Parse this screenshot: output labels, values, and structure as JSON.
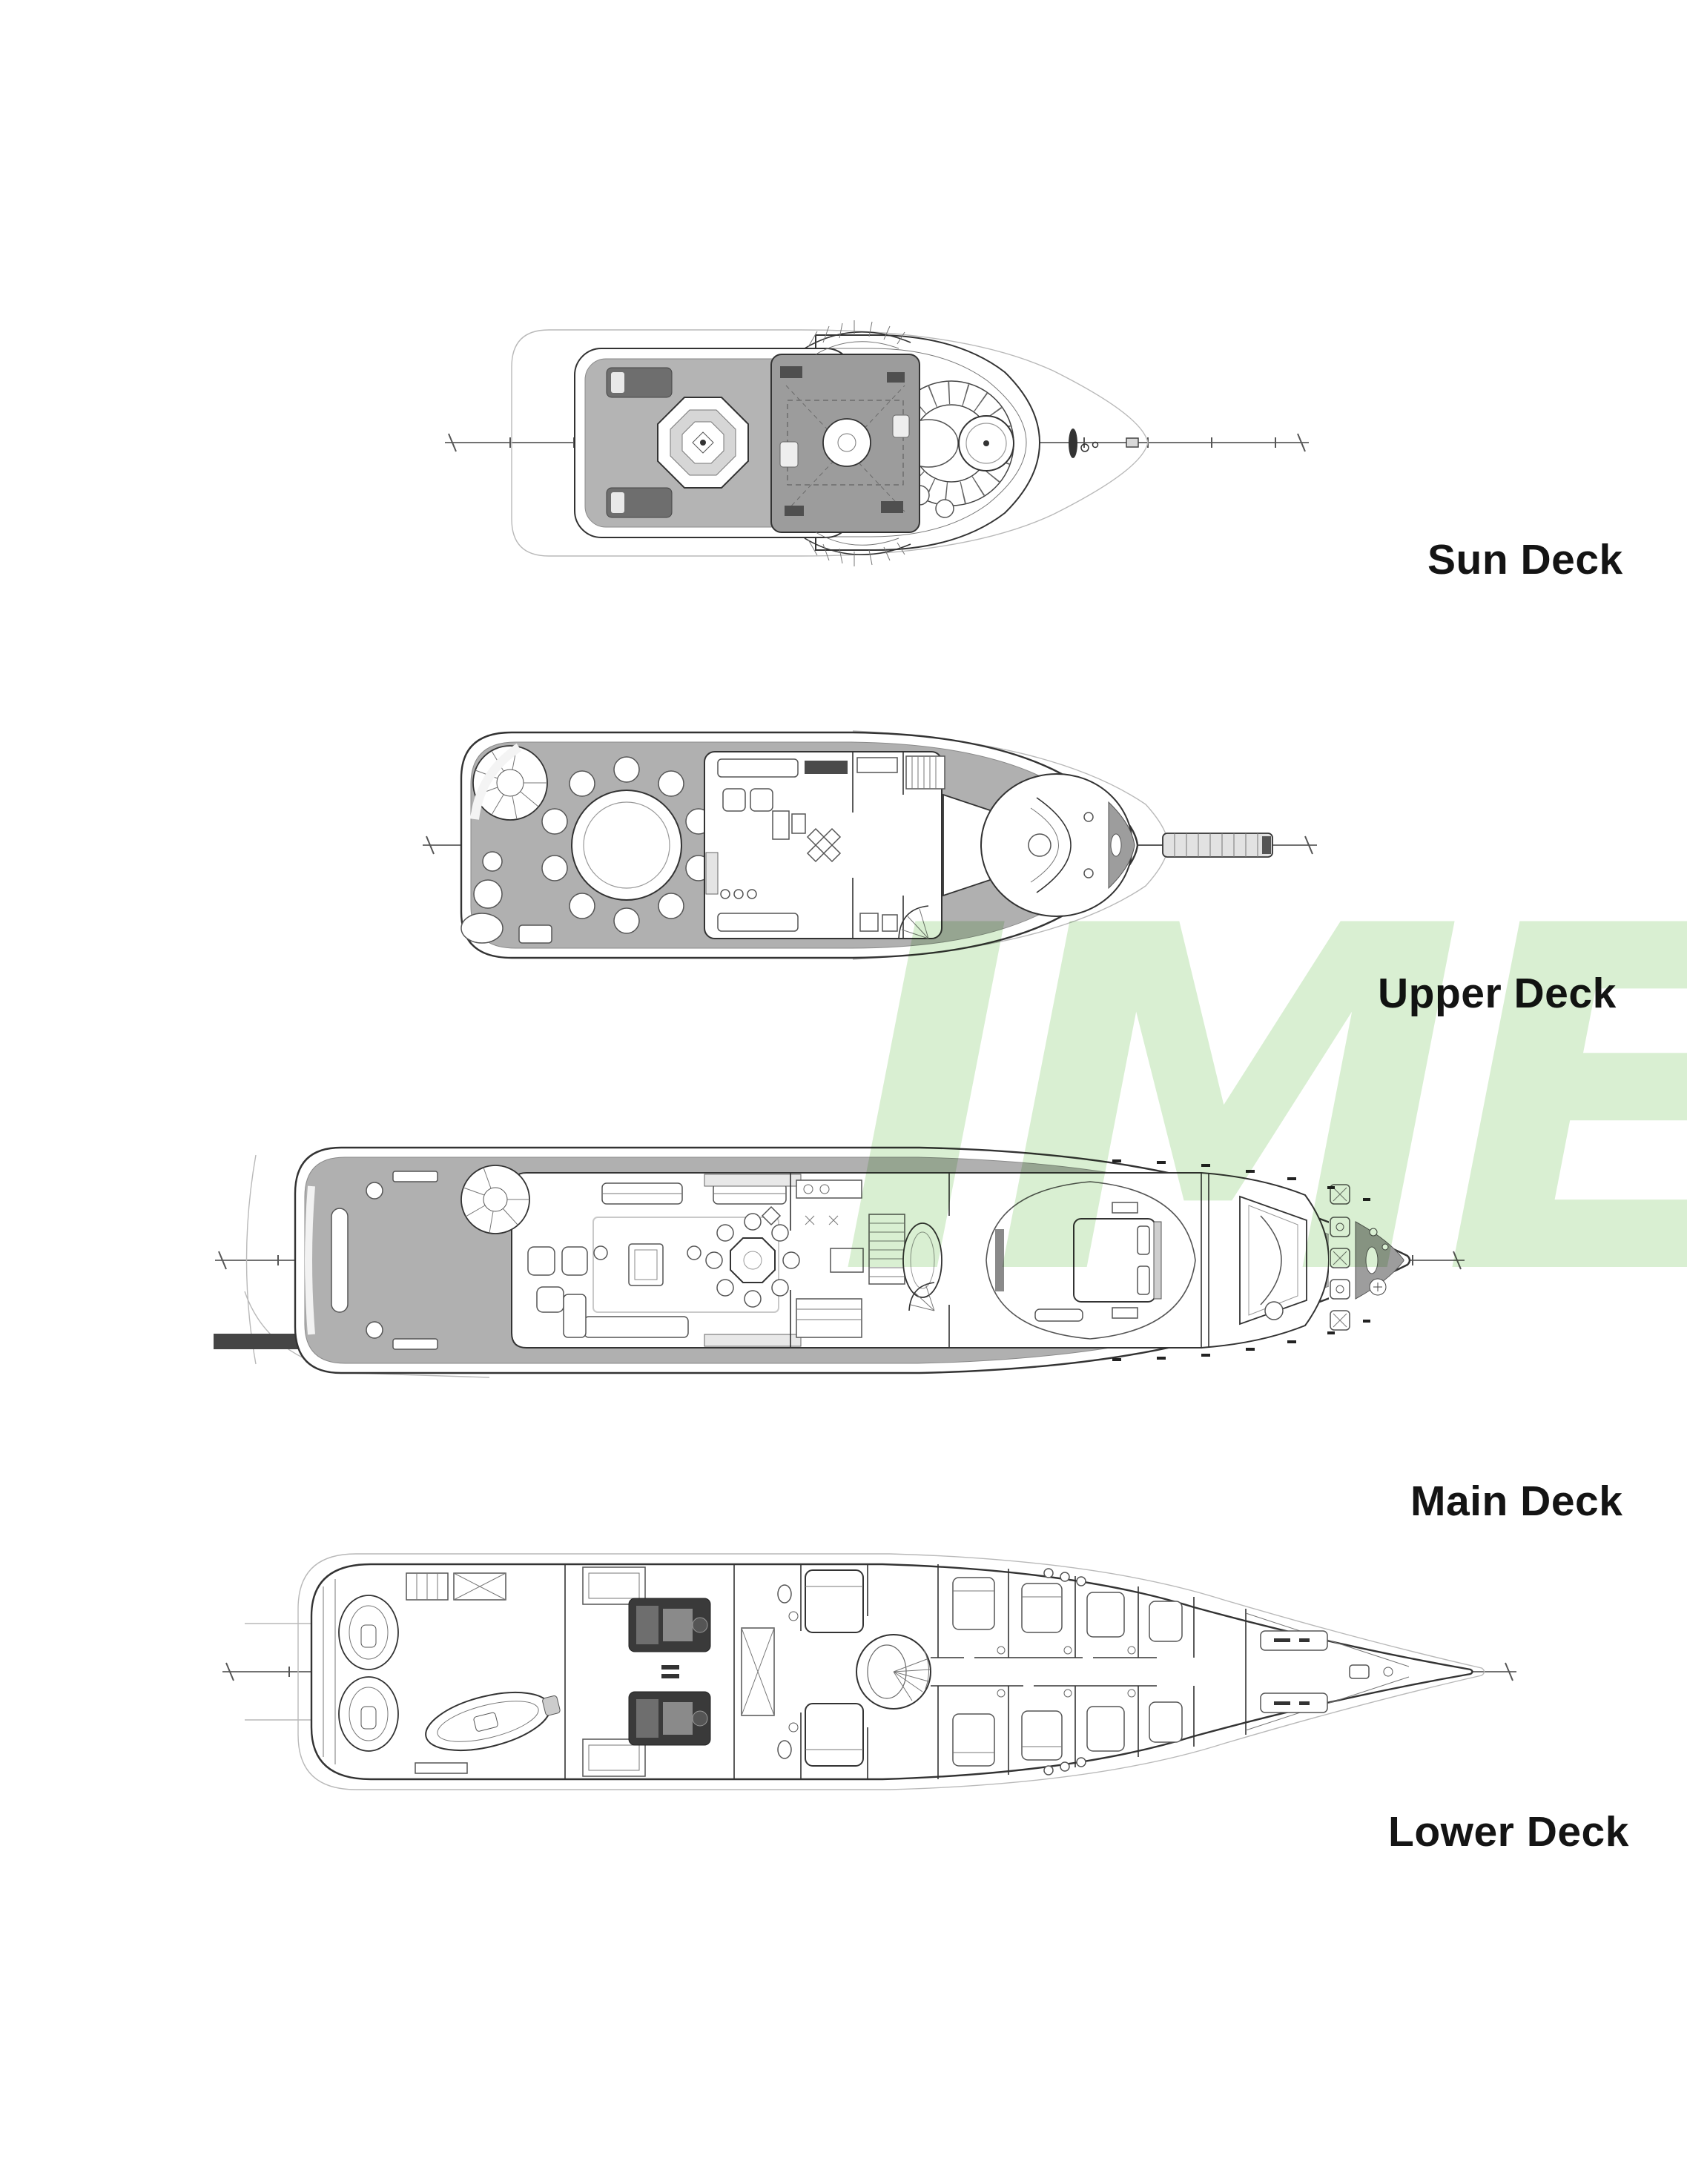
{
  "page": {
    "background_color": "#ffffff",
    "line_color": "#333333",
    "deck_shading_color": "#b0b0b0"
  },
  "watermark": {
    "text": "IME",
    "color": "#d9efd2"
  },
  "decks": [
    {
      "id": "sun-deck",
      "label": "Sun Deck",
      "features": [
        "spa pool",
        "sun loungers",
        "mast structure",
        "curved stairs",
        "circular bow seating",
        "cocktail table",
        "windlass"
      ]
    },
    {
      "id": "upper-deck",
      "label": "Upper Deck",
      "features": [
        "spiral staircase",
        "round dining table with ten chairs",
        "skylounge",
        "pilothouse",
        "bow gangway"
      ]
    },
    {
      "id": "main-deck",
      "label": "Main Deck",
      "features": [
        "swim platform",
        "aft deck",
        "salon sofas",
        "octagonal dining table",
        "galley",
        "staircase",
        "master suite",
        "wheelhouse",
        "anchor windlass"
      ]
    },
    {
      "id": "lower-deck",
      "label": "Lower Deck",
      "features": [
        "tender garage",
        "jet skis",
        "tender",
        "engine room with twin engines",
        "guest cabins",
        "circular stair lobby",
        "crew cabins",
        "forepeak"
      ]
    }
  ]
}
